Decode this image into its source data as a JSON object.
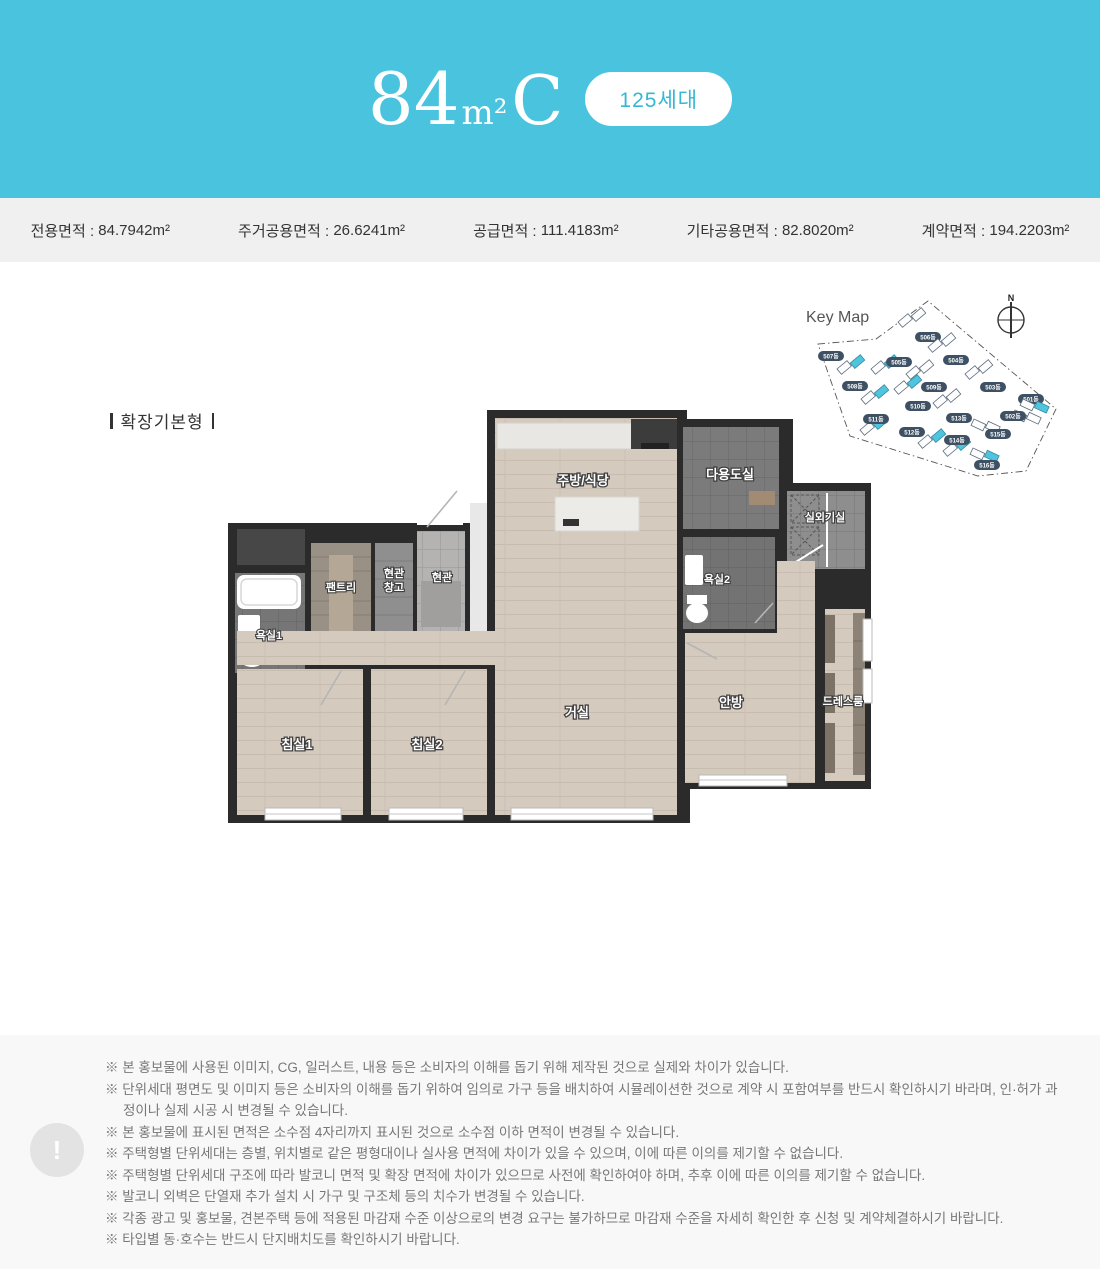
{
  "header": {
    "title_number": "84",
    "title_unit": "m²",
    "title_type": "C",
    "badge": "125세대",
    "bg_color": "#4ac4de"
  },
  "area_bar": {
    "items": [
      {
        "label": "전용면적",
        "value": "84.7942m²"
      },
      {
        "label": "주거공용면적",
        "value": "26.6241m²"
      },
      {
        "label": "공급면적",
        "value": "111.4183m²"
      },
      {
        "label": "기타공용면적",
        "value": "82.8020m²"
      },
      {
        "label": "계약면적",
        "value": "194.2203m²"
      }
    ]
  },
  "plan": {
    "variant_label": "확장기본형",
    "rooms": {
      "kitchen": "주방/식당",
      "utility": "다용도실",
      "outdoor_unit": "실외기실",
      "bath2": "욕실2",
      "pantry": "팬트리",
      "entry_storage_line1": "현관",
      "entry_storage_line2": "창고",
      "entrance": "현관",
      "bath1": "욕실1",
      "bedroom1": "침실1",
      "bedroom2": "침실2",
      "living": "거실",
      "master": "안방",
      "dressroom": "드레스룸"
    }
  },
  "keymap": {
    "title": "Key Map",
    "compass": "N",
    "accent_color": "#4fc4de",
    "buildings": [
      {
        "name": "507동",
        "highlighted": true
      },
      {
        "name": "506동",
        "highlighted": false
      },
      {
        "name": "505동",
        "highlighted": true
      },
      {
        "name": "504동",
        "highlighted": false
      },
      {
        "name": "503동",
        "highlighted": false
      },
      {
        "name": "501동",
        "highlighted": false
      },
      {
        "name": "508동",
        "highlighted": true
      },
      {
        "name": "509동",
        "highlighted": false
      },
      {
        "name": "510동",
        "highlighted": true
      },
      {
        "name": "502동",
        "highlighted": true
      },
      {
        "name": "511동",
        "highlighted": true
      },
      {
        "name": "513동",
        "highlighted": false
      },
      {
        "name": "512동",
        "highlighted": true
      },
      {
        "name": "515동",
        "highlighted": false
      },
      {
        "name": "514동",
        "highlighted": true
      },
      {
        "name": "516동",
        "highlighted": true
      }
    ]
  },
  "footer": {
    "icon": "!",
    "notes": [
      "※ 본 홍보물에 사용된 이미지, CG, 일러스트, 내용 등은 소비자의 이해를 돕기 위해 제작된 것으로 실제와 차이가 있습니다.",
      "※ 단위세대 평면도 및 이미지 등은 소비자의 이해를 돕기 위하여 임의로 가구 등을 배치하여 시뮬레이션한 것으로 계약 시 포함여부를 반드시 확인하시기 바라며, 인·허가 과정이나 실제 시공 시 변경될 수 있습니다.",
      "※ 본 홍보물에 표시된 면적은 소수점 4자리까지 표시된 것으로 소수점 이하 면적이 변경될 수 있습니다.",
      "※ 주택형별 단위세대는 층별, 위치별로 같은 평형대이나 실사용 면적에 차이가 있을 수 있으며, 이에 따른 이의를 제기할 수 없습니다.",
      "※ 주택형별 단위세대 구조에 따라 발코니 면적 및 확장 면적에 차이가 있으므로 사전에 확인하여야 하며, 추후 이에 따른 이의를 제기할 수 없습니다.",
      "※ 발코니 외벽은 단열재 추가 설치 시 가구 및 구조체 등의 치수가 변경될 수 있습니다.",
      "※ 각종 광고 및 홍보물, 견본주택 등에 적용된 마감재 수준 이상으로의 변경 요구는 불가하므로 마감재 수준을 자세히 확인한 후 신청 및 계약체결하시기 바랍니다.",
      "※ 타입별 동·호수는 반드시 단지배치도를 확인하시기 바랍니다."
    ]
  }
}
